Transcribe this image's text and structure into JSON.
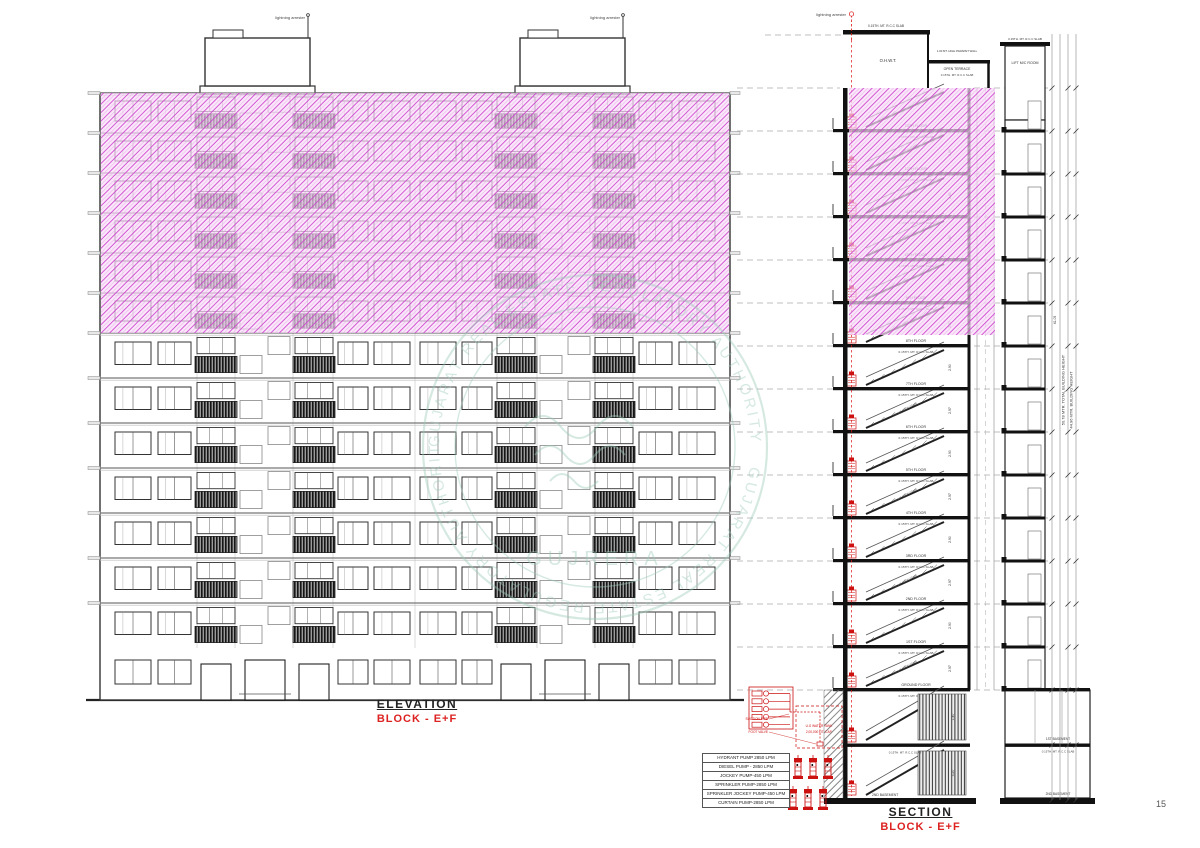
{
  "page": {
    "number": "15"
  },
  "colors": {
    "pink_hatch": "#cf3fcf",
    "pink_bg": "#f7ddf7",
    "red": "#cc1111",
    "line": "#333333",
    "slab": "#111111",
    "watermark": "#9ccbb8"
  },
  "watermark": {
    "ring_text": "GUJARAT REAL ESTATE REGULATORY AUTHORITY",
    "center_text": "GUJRERA"
  },
  "elevation": {
    "title": "ELEVATION",
    "subtitle": "BLOCK - E+F",
    "lightning_label": "lightning arrester",
    "pink_floor_count": 6,
    "white_floor_count": 7
  },
  "section": {
    "title": "SECTION",
    "subtitle": "BLOCK - E+F",
    "lightning_label": "lightning arrester",
    "slab_label": "0.15TH. MT. R.C.C SLAB",
    "stair_label": "1.50 MT. WIDE STAIR",
    "floor_labels": [
      "13TH FLOOR",
      "12TH FLOOR",
      "11TH FLOOR",
      "10TH FLOOR",
      "9TH FLOOR",
      "8TH FLOOR",
      "7TH FLOOR",
      "6TH FLOOR",
      "5TH FLOOR",
      "4TH FLOOR",
      "3RD FLOOR",
      "2ND FLOOR",
      "1ST FLOOR",
      "GROUND FLOOR"
    ],
    "top_labels": {
      "tank": "O.H.W.T.",
      "terrace": "OPEN TERRACE",
      "parapet": "1.00 MT. HIGH PARAPET WALL",
      "lift_room": "LIFT M/C ROOM"
    },
    "basement_labels": {
      "b1": "1ST BASEMENT",
      "b2": "2ND BASEMENT"
    },
    "dims": {
      "total_height": "50.78 MTR. TOTAL BUILDING HEIGHT",
      "building_height": "44.96 MTR. BUILDING HEIGHT",
      "upper": "41.05",
      "floor": "2.97",
      "floor_alt": "2.90",
      "basement_upper": "1.40",
      "basement_lower": "3.20"
    }
  },
  "pump_room": {
    "labels": {
      "suction": "SUCTION PIPE",
      "tank": "U.G WATER TANK",
      "capacity": "2,00,000 LIT. CAP.",
      "foot_valve": "FOOT VALVE"
    }
  },
  "pump_table": {
    "rows": [
      "HYDRANT PUMP 2850 LPM",
      "DIESEL PUMP - 2850 LPM",
      "JOCKEY PUMP-450 LPM",
      "SPRINKLER PUMP-2850 LPM",
      "SPRINKLER JOCKEY PUMP-450 LPM",
      "CURTAIN PUMP-2850 LPM"
    ]
  }
}
